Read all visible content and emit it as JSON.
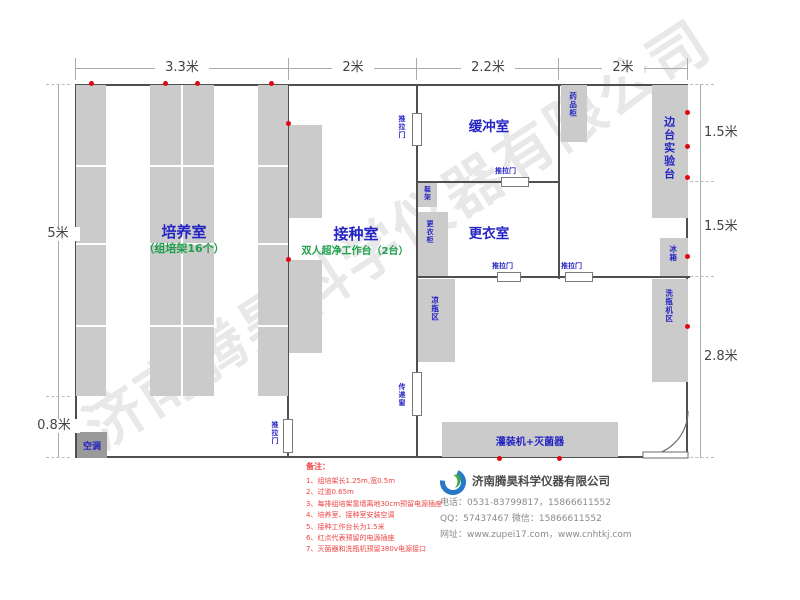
{
  "watermark": "济南腾昊科学仪器有限公司",
  "dimensions": {
    "top_segments": [
      "3.3米",
      "2米",
      "2.2米",
      "2米"
    ],
    "left_segments": [
      "5米",
      "0.8米"
    ],
    "right_segments": [
      "1.5米",
      "1.5米",
      "2.8米"
    ]
  },
  "rooms": {
    "cultivation": {
      "name": "培养室",
      "note": "（组培架16个）"
    },
    "inoculation": {
      "name": "接种室",
      "note": "双人超净工作台（2台）"
    },
    "buffer": {
      "name": "缓冲室"
    },
    "changing": {
      "name": "更衣室"
    }
  },
  "fixtures": {
    "sliding_door": "推拉门",
    "pass_window": "传递窗",
    "medicine_cabinet": "药品柜",
    "side_bench": "边台实验台",
    "fridge": "冰箱",
    "bottle_washer_area": "洗瓶机区",
    "shoe_rack": "鞋架",
    "wardrobe": "更衣柜",
    "bottle_cooling_area": "凉瓶区",
    "filling_sterilizer": "灌装机+灭菌器",
    "air_conditioner": "空调"
  },
  "notes": {
    "title": "备注：",
    "items": [
      "1、组培架长1.25m,宽0.5m",
      "2、过道0.65m",
      "3、每排组培架靠墙离地30cm预留电源插座",
      "4、培养室、接种室安装空调",
      "5、接种工作台长为1.5米",
      "6、红点代表预留的电源插座",
      "7、灭菌器和洗瓶机预留380v电源接口"
    ]
  },
  "company": {
    "name": "济南腾昊科学仪器有限公司",
    "phone": "电话：0531-83799817，15866611552",
    "qq_wechat": "QQ：57437467   微信：15866611552",
    "website": "网址：www.zupei17.com，www.cnhtkj.com"
  },
  "colors": {
    "label_blue": "#2424c4",
    "note_green": "#1da04b",
    "outlet_red": "#e30613",
    "note_red": "#ee4545",
    "furniture_gray": "#cbcbcb",
    "wall": "#4f4f4f"
  }
}
